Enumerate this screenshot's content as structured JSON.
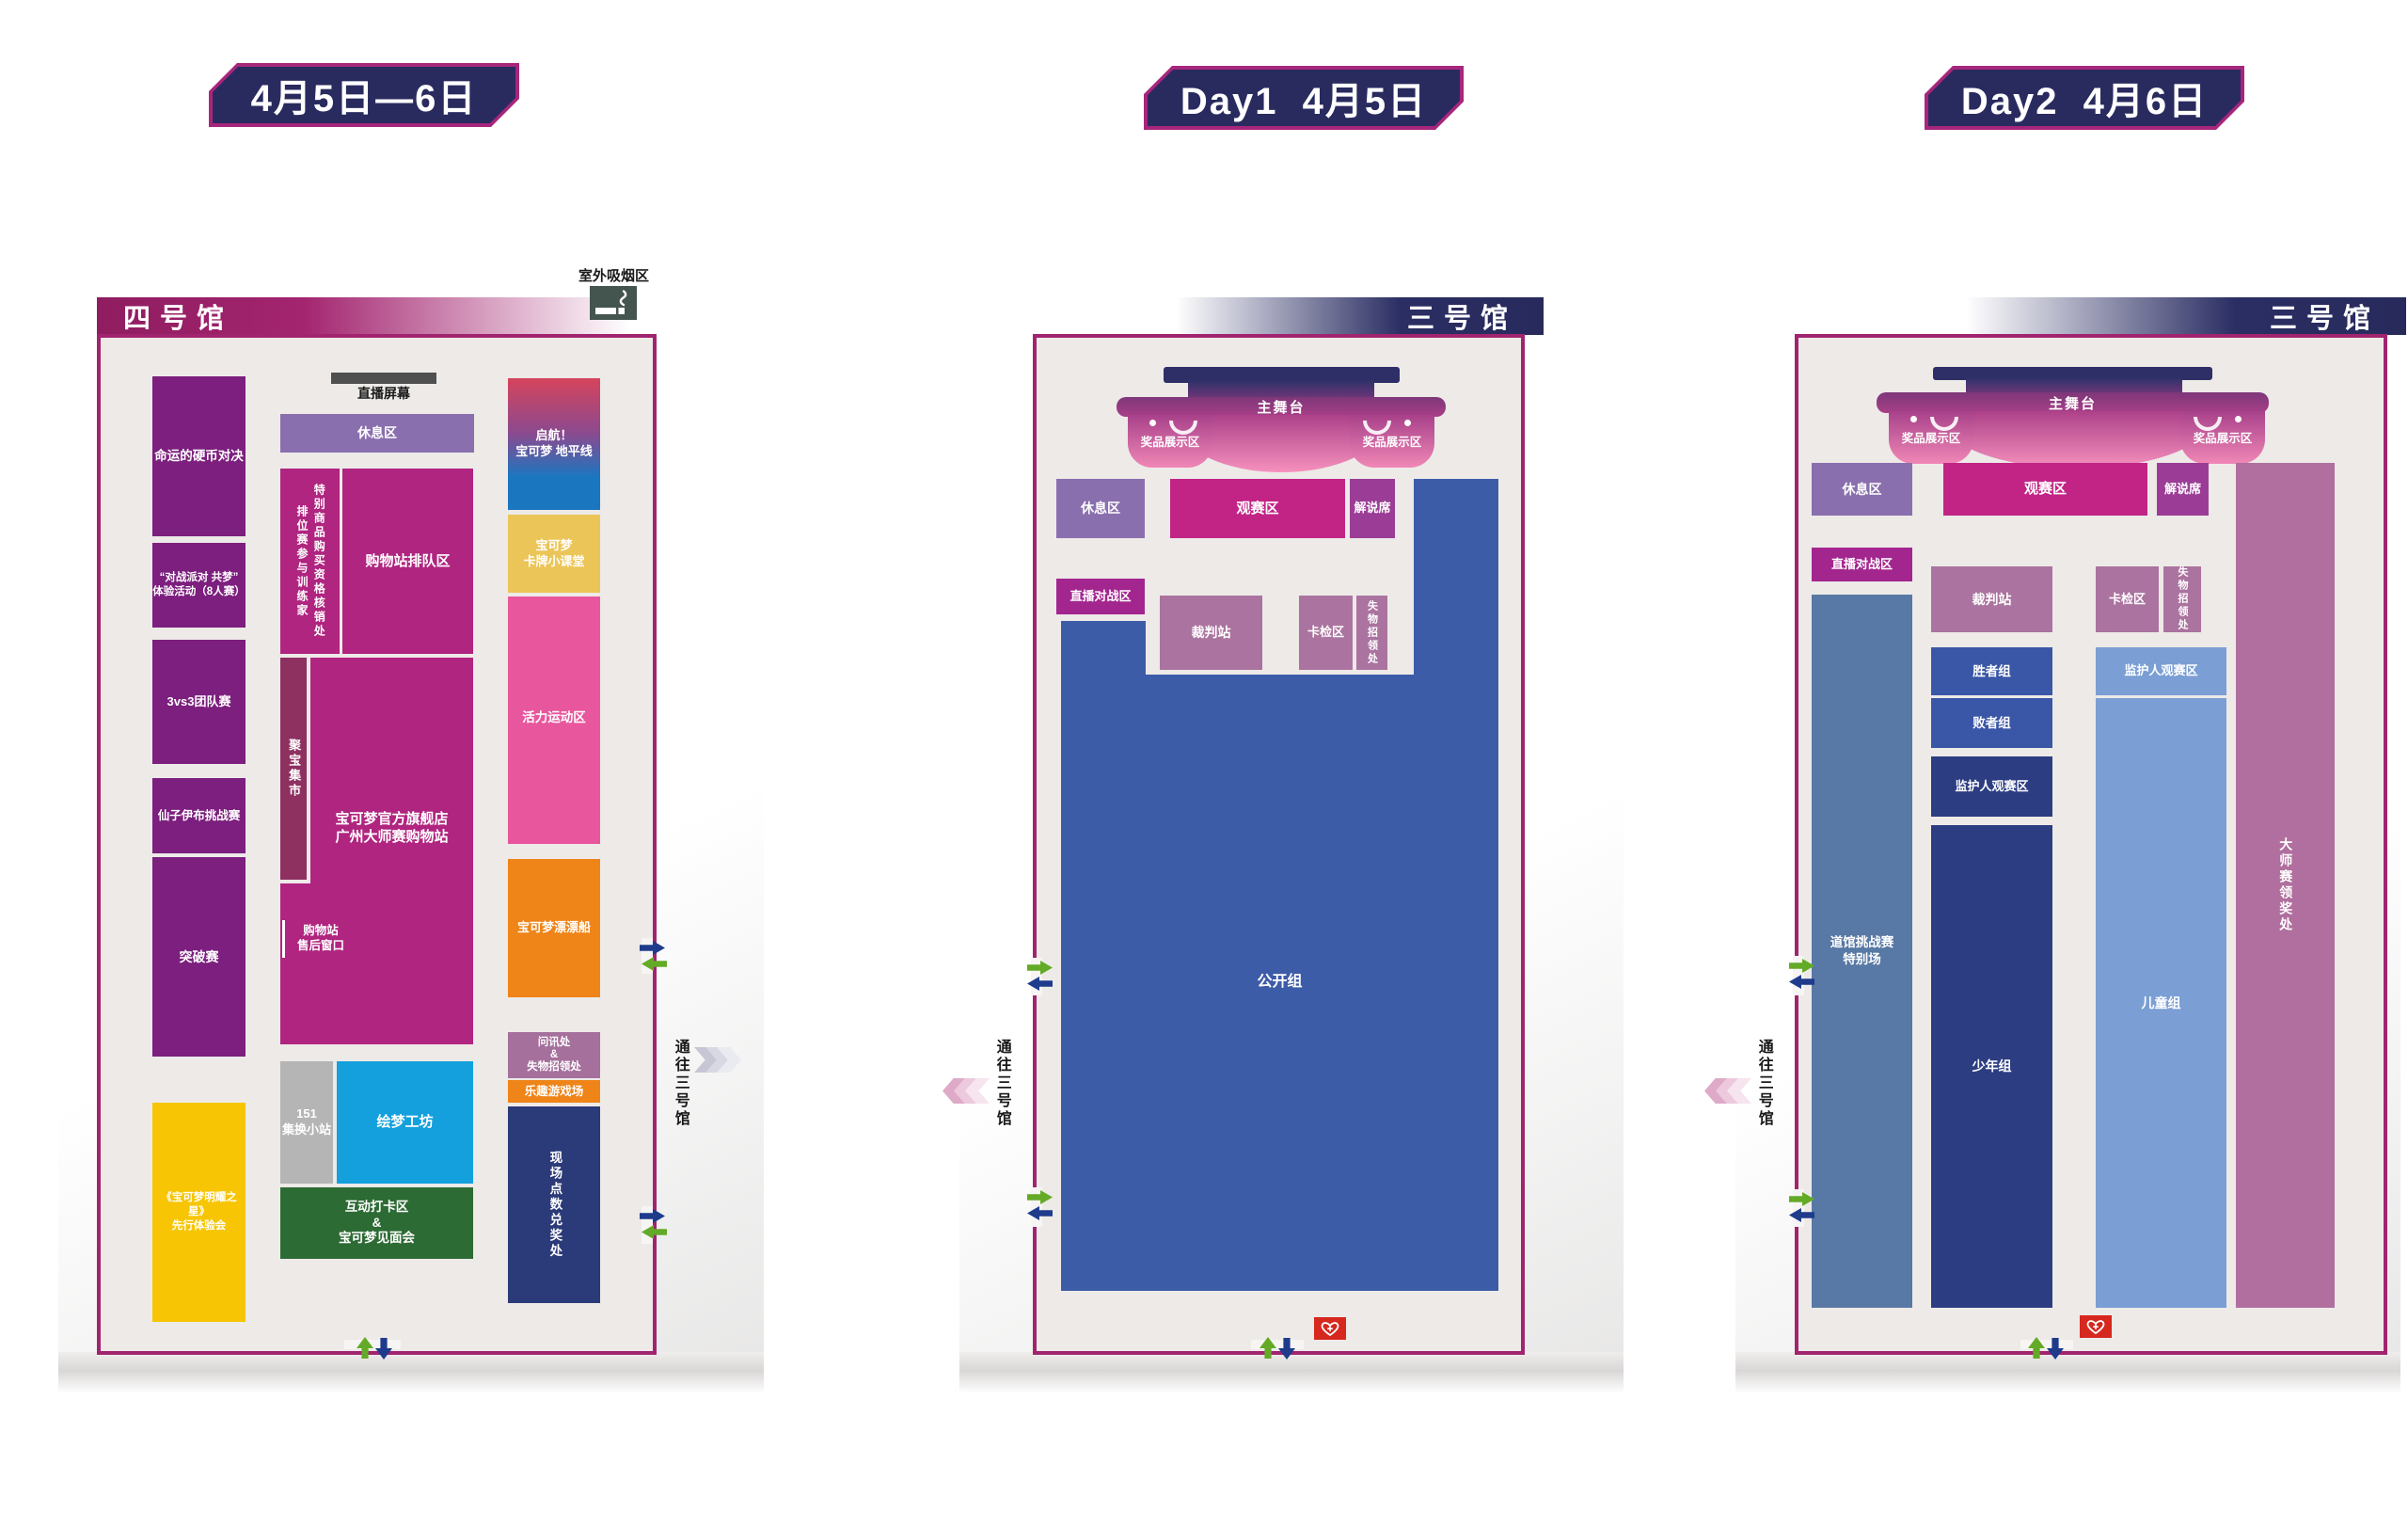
{
  "badges": {
    "range": "4月5日—6日",
    "day1": "Day1  4月5日",
    "day2": "Day2  4月6日"
  },
  "colors": {
    "badge_navy": "#292b5f",
    "badge_border": "#a7267c",
    "map_border": "#a1246f",
    "map_bg": "#edeae8",
    "purple_event": "#7c1f7e",
    "yellow_event": "#f7c504",
    "magenta_shop": "#b02580",
    "maroon_market": "#8e3060",
    "light_purple_rest": "#8a6fae",
    "gray_151": "#b5b5b5",
    "cyan_workshop": "#14a0dc",
    "green_meet": "#2d6b35",
    "gold_class": "#ecc558",
    "pink_sport": "#e8569d",
    "orange": "#ef8418",
    "mauve_info": "#a5709c",
    "navy_redeem": "#2b3a78",
    "stage_navy": "#2d2f66",
    "stage_pink": "#f591bd",
    "magenta_view": "#c22486",
    "purple_commentary": "#9b3d96",
    "magenta_live": "#a3268f",
    "mauve_referee": "#ab739f",
    "blue_open": "#3d5ca8",
    "slate_gym": "#5878a5",
    "blue_group": "#3a57a7",
    "navy_group": "#2c3d82",
    "steel_group": "#7b9fd4",
    "plum_prize": "#b06f9e",
    "red_aed": "#d6281e",
    "arrow_green": "#63aa26",
    "arrow_navy": "#1e3b8c",
    "smoking_box": "#44544f"
  },
  "hall4": {
    "title": "四号馆",
    "smoking_label": "室外吸烟区",
    "live_screen": "直播屏幕",
    "zones": {
      "coin_duel": "命运的硬币对决",
      "battle_party": "“对战派对 共梦”\n体验活动（8人赛）",
      "team_3v3": "3vs3团队赛",
      "sylveon": "仙子伊布挑战赛",
      "breakthrough": "突破赛",
      "shining_star": "《宝可梦明耀之星》\n先行体验会",
      "rest": "休息区",
      "ranked_trainers": "排位赛参与训练家",
      "special_merch": "特别商品购买资格核销处",
      "shop_queue": "购物站排队区",
      "treasure_market": "聚宝集市",
      "flagship_shop": "宝可梦官方旗舰店\n广州大师赛购物站",
      "aftersale": "购物站\n售后窗口",
      "station_151": "151\n集换小站",
      "dream_workshop": "绘梦工坊",
      "photo_meet": "互动打卡区\n&\n宝可梦见面会",
      "horizons": "启航！\n宝可梦 地平线",
      "card_class": "宝可梦\n卡牌小课堂",
      "sports": "活力运动区",
      "float_boat": "宝可梦漂漂船",
      "info_lost": "问讯处\n&\n失物招领处",
      "fun_playground": "乐趣游戏场",
      "points_redeem": "现场点数兑奖处"
    },
    "passage": "通往三号馆"
  },
  "hall3_day1": {
    "title": "三号馆",
    "stage": "主舞台",
    "prize_left": "奖品展示区",
    "prize_right": "奖品展示区",
    "zones": {
      "rest": "休息区",
      "viewing": "观赛区",
      "commentary": "解说席",
      "live_battle": "直播对战区",
      "referee": "裁判站",
      "card_check": "卡检区",
      "lost_found": "失物招领处",
      "open_group": "公开组"
    },
    "passage": "通往三号馆"
  },
  "hall3_day2": {
    "title": "三号馆",
    "stage": "主舞台",
    "prize_left": "奖品展示区",
    "prize_right": "奖品展示区",
    "zones": {
      "rest": "休息区",
      "viewing": "观赛区",
      "commentary": "解说席",
      "live_battle": "直播对战区",
      "referee": "裁判站",
      "card_check": "卡检区",
      "lost_found": "失物招领处",
      "gym_special": "道馆挑战赛\n特别场",
      "winners": "胜者组",
      "losers": "败者组",
      "guardian_view_left": "监护人观赛区",
      "juniors": "少年组",
      "guardian_view_right": "监护人观赛区",
      "children": "儿童组",
      "masters_prize": "大师赛领奖处"
    },
    "passage": "通往三号馆"
  }
}
